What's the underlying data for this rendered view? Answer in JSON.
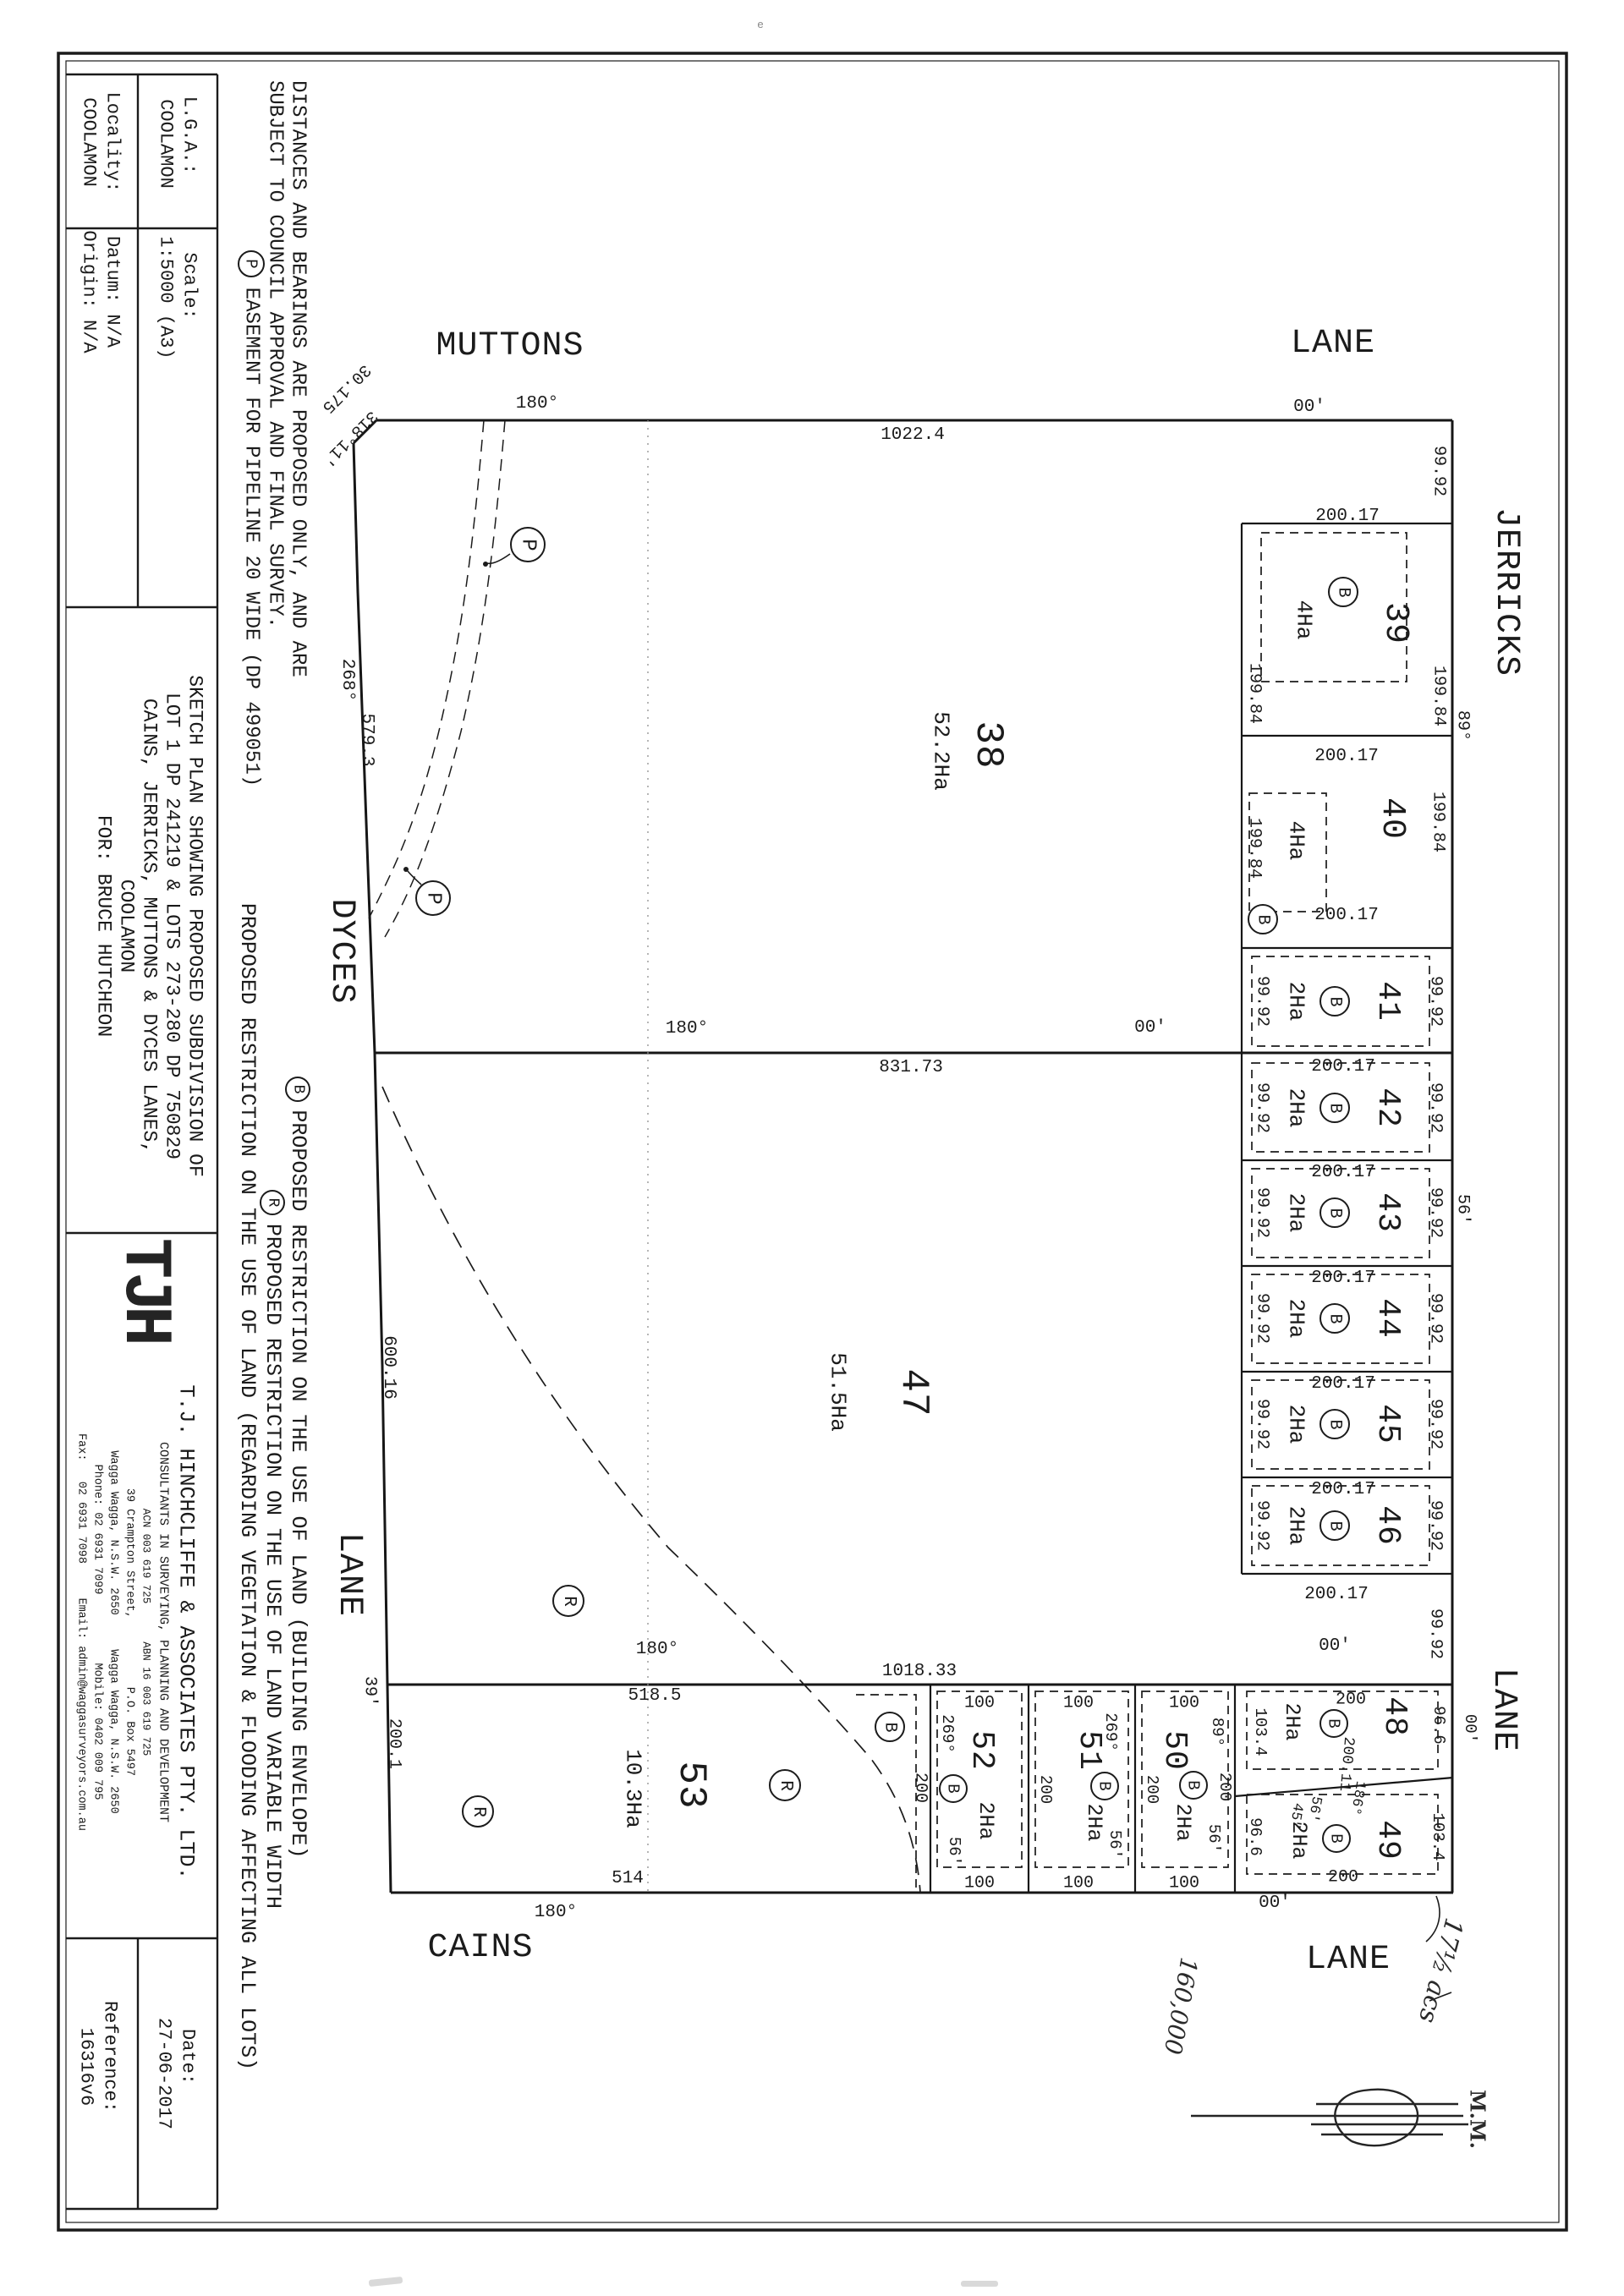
{
  "title_block": {
    "lga_label": "L.G.A.:",
    "lga_value": "COOLAMON",
    "locality_label": "Locality:",
    "locality_value": "COOLAMON",
    "scale_label": "Scale:",
    "scale_value": "1:5000 (A3)",
    "datum": "Datum: N/A",
    "origin": "Origin: N/A",
    "sketch_lines": [
      "SKETCH PLAN SHOWING PROPOSED SUBDIVISION OF",
      "LOT 1 DP 241219 & LOTS 273-280 DP 750829",
      "CAINS, JERRICKS, MUTTONS & DYCES LANES,",
      "COOLAMON",
      "FOR: BRUCE HUTCHEON"
    ],
    "logo": "TJH",
    "company": {
      "name": "T.J. HINCHCLIFFE & ASSOCIATES PTY. LTD.",
      "tagline": "CONSULTANTS IN SURVEYING, PLANNING AND DEVELOPMENT",
      "regline": "ACN 003 619 725      ABN 16 003 619 725",
      "addr1": "39 Crampton Street,          P.O. Box 5497",
      "addr2": "Wagga Wagga, N.S.W. 2650     Wagga Wagga, N.S.W. 2650",
      "contact1": "Phone: 02 6931 7099          Mobile: 0402 009 795",
      "contact2": "Fax:   02 6931 7098     Email: admin@waggasurveyors.com.au"
    },
    "date_label": "Date:",
    "date_value": "27-06-2017",
    "ref_label": "Reference:",
    "ref_value": "16316v6"
  },
  "notes": {
    "disclaimer1": "DISTANCES AND BEARINGS ARE PROPOSED ONLY, AND ARE",
    "disclaimer2": "SUBJECT TO COUNCIL APPROVAL AND FINAL SURVEY.",
    "easement": "EASEMENT FOR PIPELINE 20 WIDE (DP 499051)",
    "b_note": "PROPOSED RESTRICTION ON THE USE OF LAND (BUILDING ENVELOPE)",
    "r_note": "PROPOSED RESTRICTION ON THE USE OF LAND VARIABLE WIDTH",
    "r_note2": "PROPOSED RESTRICTION ON THE USE OF LAND (REGARDING VEGETATION & FLOODING AFFECTING ALL LOTS)"
  },
  "roads": {
    "muttons": "MUTTONS",
    "lane_top": "LANE",
    "jerricks": "JERRICKS",
    "lane_right": "LANE",
    "dyces": "DYCES",
    "lane_left": "LANE",
    "cains": "CAINS",
    "lane_bottom": "LANE"
  },
  "symbols": {
    "b": "B",
    "p": "P",
    "r": "R"
  },
  "lots": {
    "38": {
      "num": "38",
      "area": "52.2Ha"
    },
    "39": {
      "num": "39",
      "area": "4Ha"
    },
    "40": {
      "num": "40",
      "area": "4Ha"
    },
    "41": {
      "num": "41",
      "area": "2Ha"
    },
    "42": {
      "num": "42",
      "area": "2Ha"
    },
    "43": {
      "num": "43",
      "area": "2Ha"
    },
    "44": {
      "num": "44",
      "area": "2Ha"
    },
    "45": {
      "num": "45",
      "area": "2Ha"
    },
    "46": {
      "num": "46",
      "area": "2Ha"
    },
    "47": {
      "num": "47",
      "area": "51.5Ha"
    },
    "48": {
      "num": "48",
      "area": "2Ha"
    },
    "49": {
      "num": "49",
      "area": "2Ha"
    },
    "50": {
      "num": "50",
      "area": "2Ha"
    },
    "51": {
      "num": "51",
      "area": "2Ha"
    },
    "52": {
      "num": "52",
      "area": "2Ha"
    },
    "53": {
      "num": "53",
      "area": "10.3Ha"
    }
  },
  "dims": {
    "d1022_4": "1022.4",
    "d200_17": "200.17",
    "d99_92": "99.92",
    "d199_84": "199.84",
    "d831_73": "831.73",
    "d600_16": "600.16",
    "d579_3": "579.3",
    "d1018_33": "1018.33",
    "d518_5": "518.5",
    "d514": "514",
    "d200_1": "200.1",
    "d200": "200",
    "d200_11": "200.11",
    "d100": "100",
    "d96_6": "96.6",
    "d103_4": "103.4",
    "d30_175": "30.175"
  },
  "bearings": {
    "b180": "180°",
    "b00": "00'",
    "b268": "268°",
    "b269": "269°",
    "b89": "89°",
    "b56": "56'",
    "b39": "39'",
    "b318_11": "318°11'",
    "b186": "186°",
    "b45": "45\""
  },
  "annotations": {
    "hw1": "17½ acs",
    "hw2": "160,000",
    "initials": "M.M.",
    "artifact": "e"
  }
}
